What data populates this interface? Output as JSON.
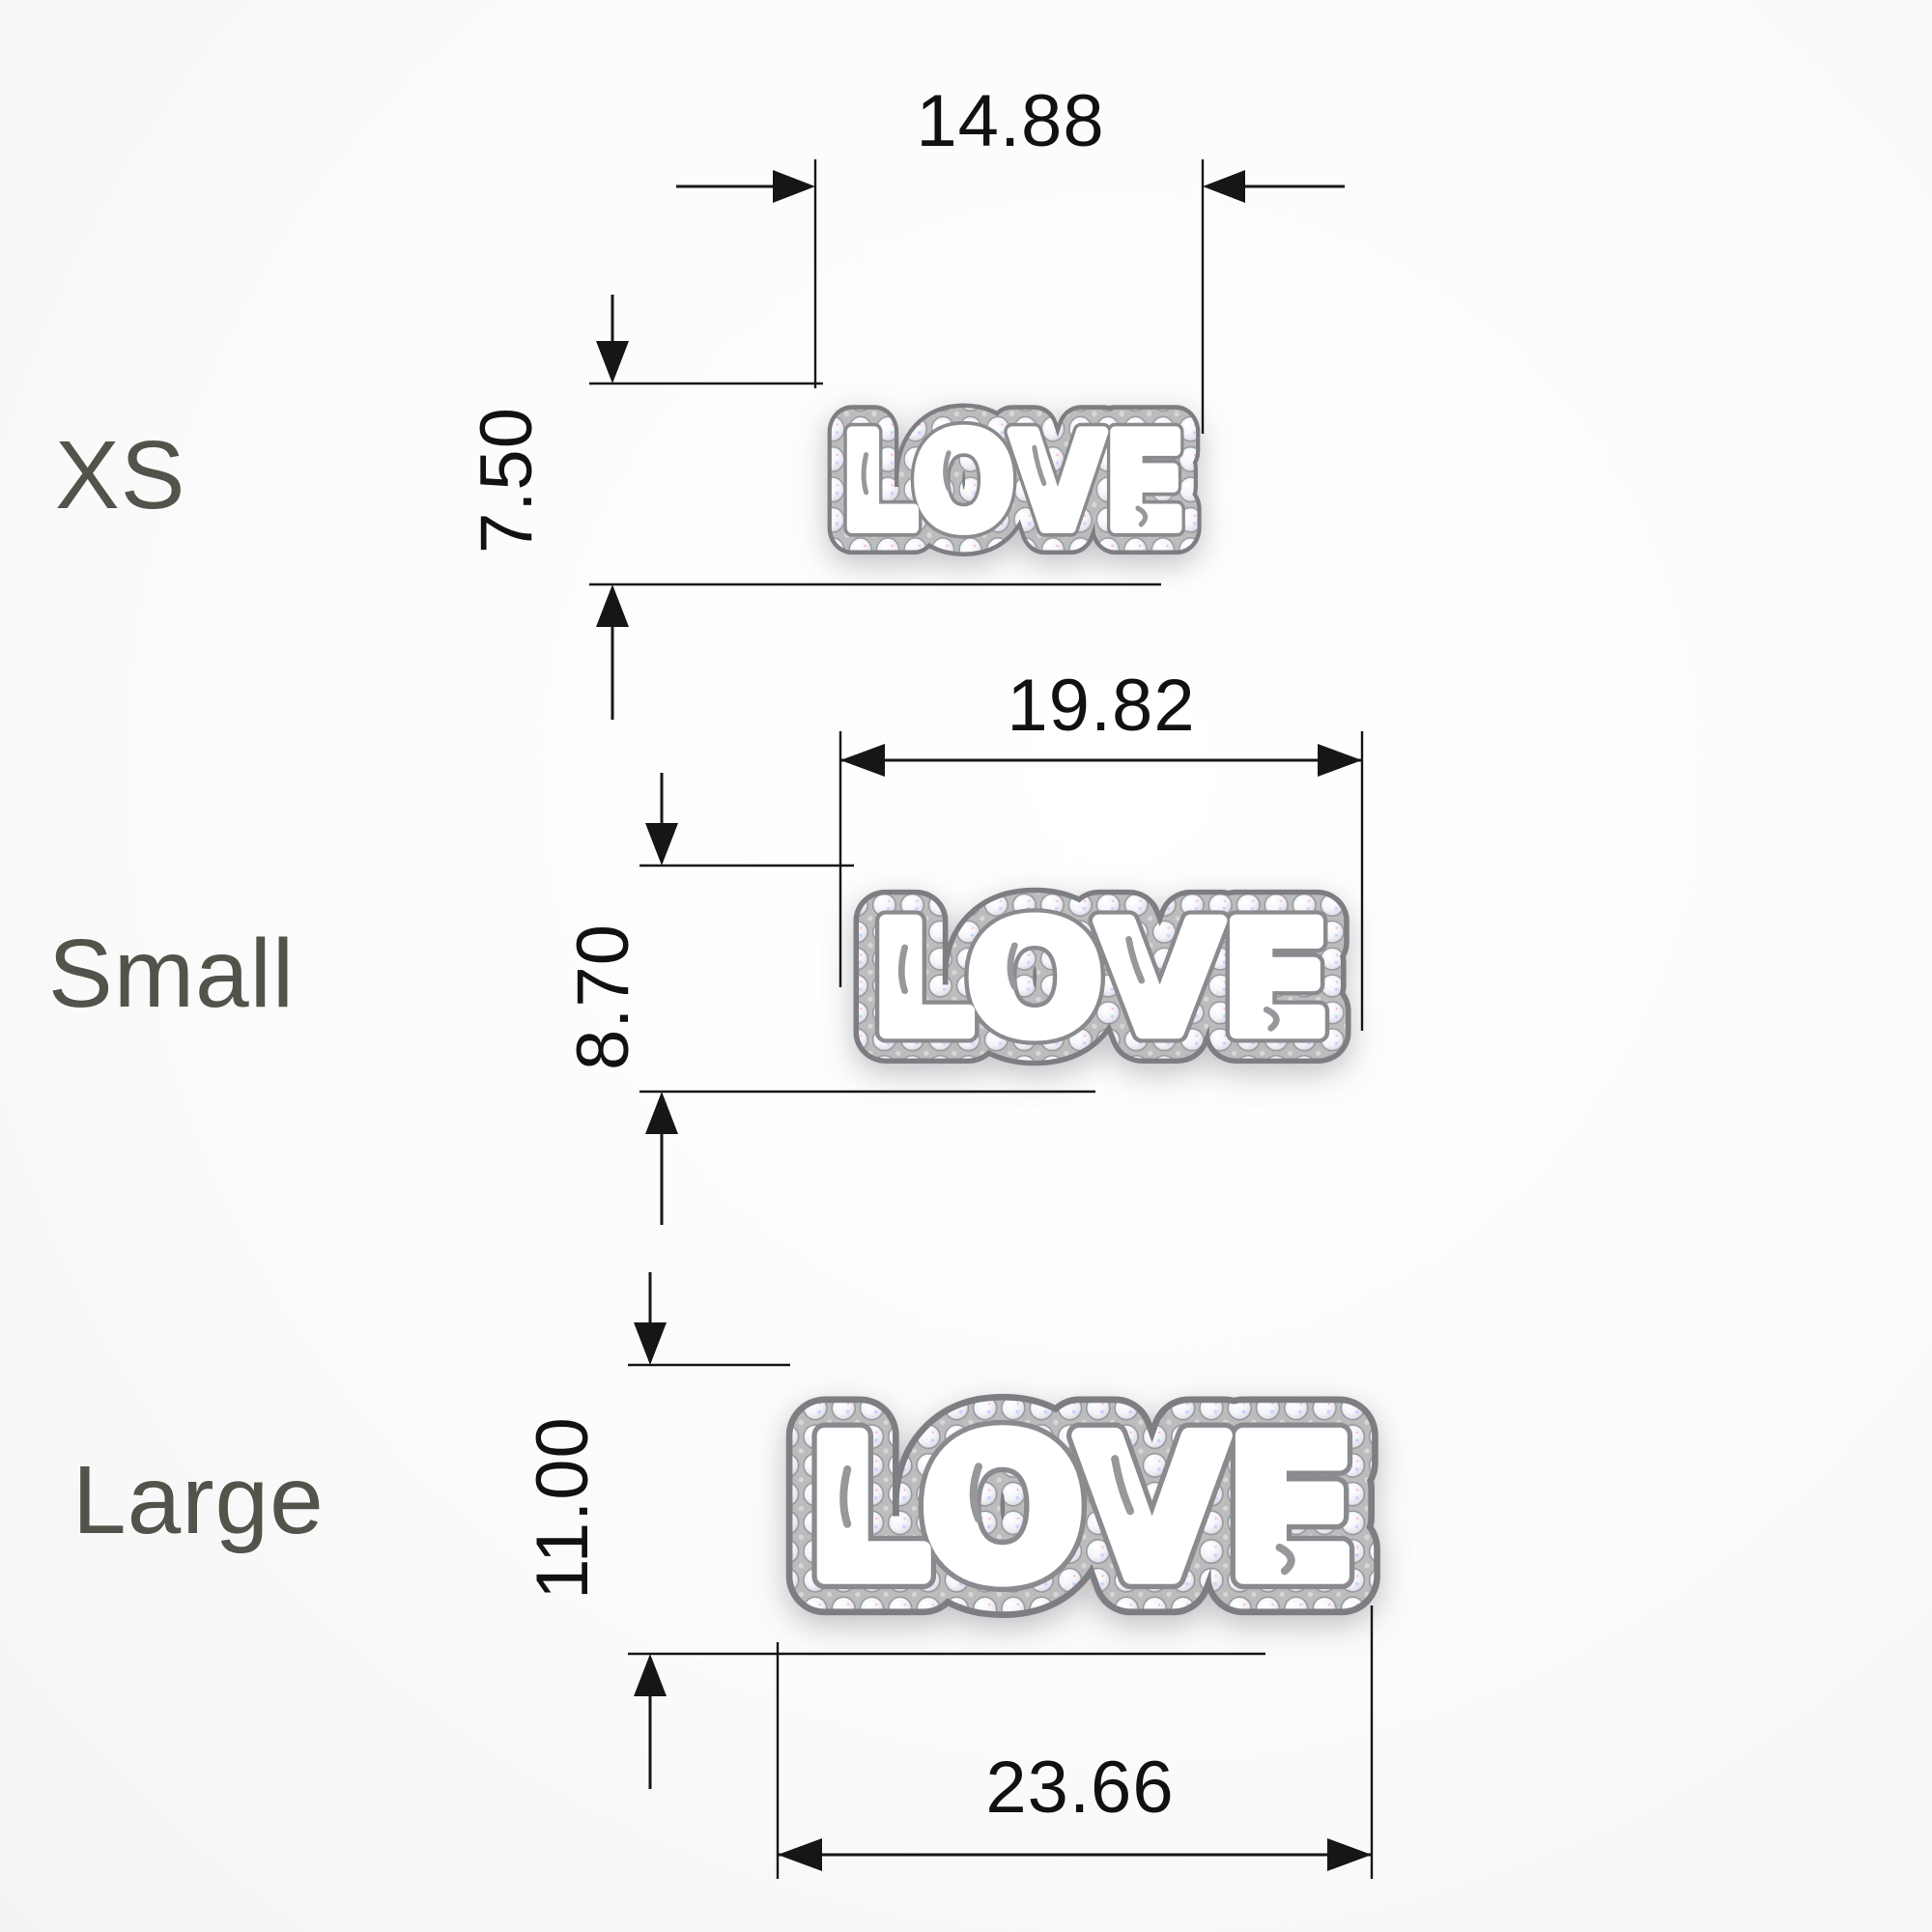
{
  "colors": {
    "label_text": "#53534b",
    "dimension_ink": "#161616",
    "metal": "#bcbcbc",
    "diamond": "#ffffff",
    "background": "#f2f2f2"
  },
  "rows": [
    {
      "id": "xs",
      "label": "XS",
      "word": "LOVE",
      "width": "14.88",
      "height": "7.50"
    },
    {
      "id": "small",
      "label": "Small",
      "word": "LOVE",
      "width": "19.82",
      "height": "8.70"
    },
    {
      "id": "large",
      "label": "Large",
      "word": "LOVE",
      "width": "23.66",
      "height": "11.00"
    }
  ]
}
